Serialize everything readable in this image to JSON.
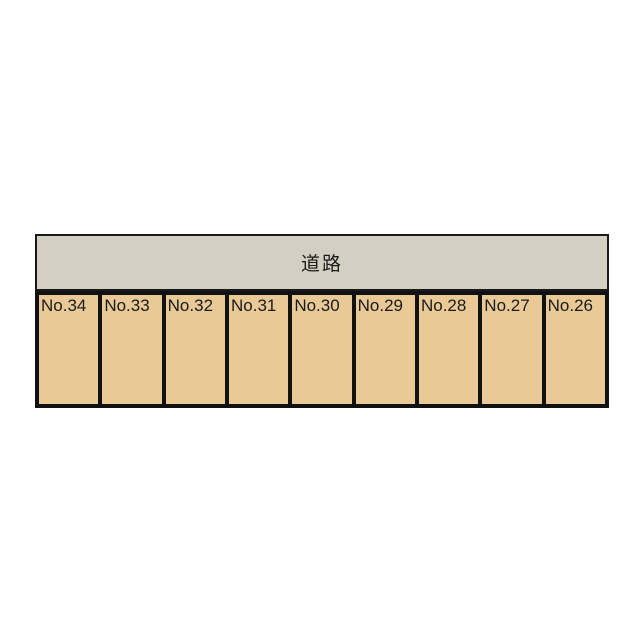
{
  "colors": {
    "background": "#ffffff",
    "road_fill": "#d3d0c3",
    "road_border": "#1a1a1a",
    "stall_fill": "#e9ca97",
    "stall_border": "#111111",
    "text": "#1a1a1a"
  },
  "road": {
    "label": "道路"
  },
  "parking": {
    "spaces": [
      {
        "label": "No.34"
      },
      {
        "label": "No.33"
      },
      {
        "label": "No.32"
      },
      {
        "label": "No.31"
      },
      {
        "label": "No.30"
      },
      {
        "label": "No.29"
      },
      {
        "label": "No.28"
      },
      {
        "label": "No.27"
      },
      {
        "label": "No.26"
      }
    ]
  }
}
